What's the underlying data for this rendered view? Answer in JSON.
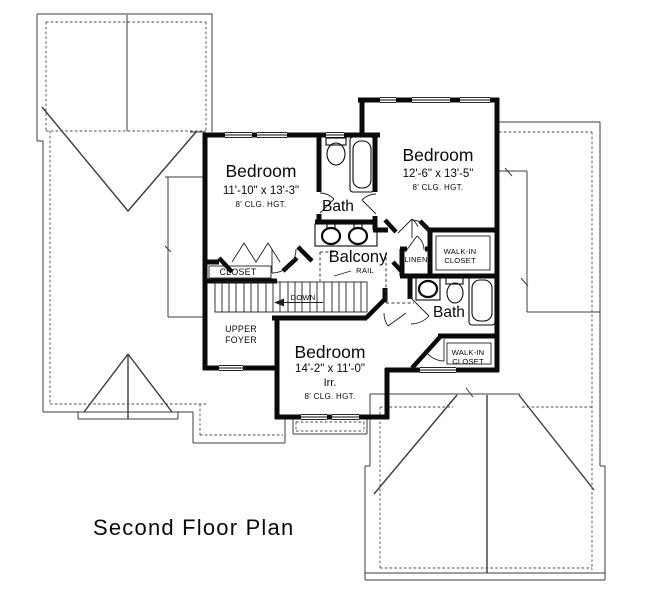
{
  "title": "Second Floor Plan",
  "labels": {
    "bedroom1": {
      "name": "Bedroom",
      "dims": "11'-10\" x 13'-3\"",
      "clg": "8' CLG. HGT."
    },
    "bedroom2": {
      "name": "Bedroom",
      "dims": "12'-6\" x 13'-5\"",
      "clg": "8' CLG. HGT."
    },
    "bedroom3": {
      "name": "Bedroom",
      "dims": "14'-2\" x 11'-0\"",
      "irr": "Irr.",
      "clg": "8' CLG. HGT."
    },
    "bath1": "Bath",
    "bath2": "Bath",
    "balcony": "Balcony",
    "rail": "RAIL",
    "linen": "LINEN",
    "wic1": {
      "l1": "WALK-IN",
      "l2": "CLOSET"
    },
    "wic2": {
      "l1": "WALK-IN",
      "l2": "CLOSET"
    },
    "closet": "CLOSET",
    "foyer": {
      "l1": "UPPER",
      "l2": "FOYER"
    },
    "down": "DOWN"
  },
  "colors": {
    "wall": "#0a0a0a",
    "roof_line": "#3c3c3c",
    "background": "#ffffff"
  }
}
